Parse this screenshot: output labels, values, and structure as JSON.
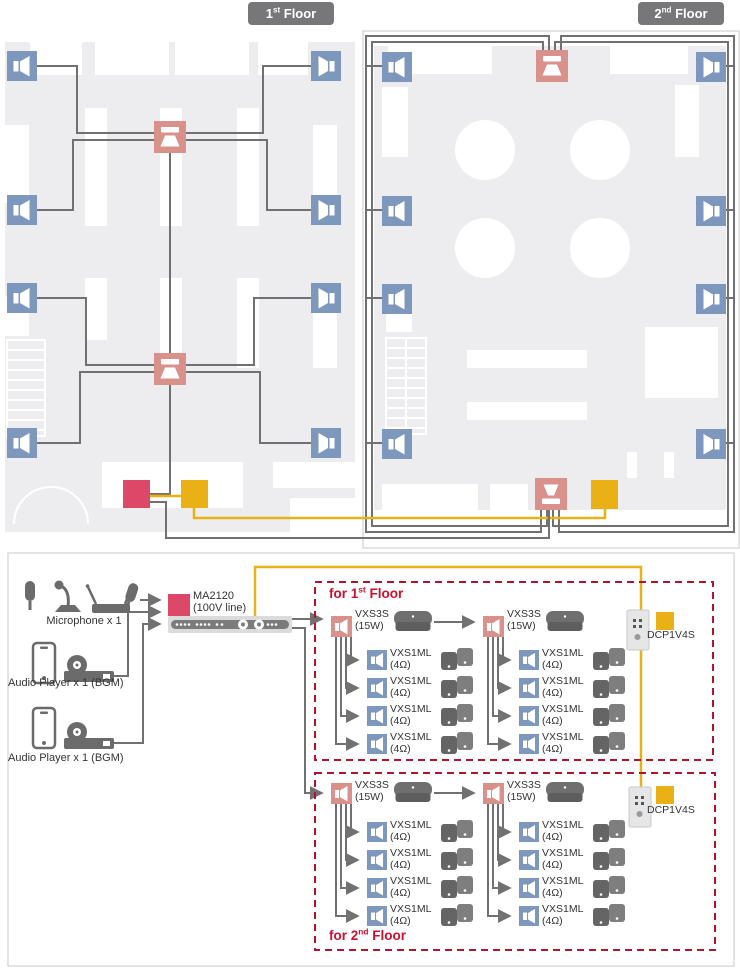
{
  "colors": {
    "accent_red": "#dd4868",
    "accent_yellow": "#eab117",
    "speaker_blue": "#7e97bd",
    "speaker_pink": "#d9918c",
    "wire_gray": "#717171",
    "zone_border_red": "#b5122f",
    "zone_title_red": "#ce0e2d",
    "chip_gray": "#77777a"
  },
  "floor_plans": {
    "floor1_chip": {
      "num": "1",
      "ord": "st",
      "word": " Floor"
    },
    "floor2_chip": {
      "num": "2",
      "ord": "nd",
      "word": " Floor"
    }
  },
  "schematic": {
    "sources": {
      "microphone_label": "Microphone x 1",
      "audio_player1_label": "Audio Player x 1 (BGM)",
      "audio_player2_label": "Audio Player x 1 (BGM)"
    },
    "amplifier": {
      "model": "MA2120",
      "note": "(100V line)"
    },
    "zone1": {
      "title": {
        "prefix": "for ",
        "num": "1",
        "ord": "st",
        "word": " Floor"
      },
      "col1_speaker": {
        "model": "VXS3S",
        "power": "(15W)"
      },
      "col2_speaker": {
        "model": "VXS3S",
        "power": "(15W)"
      },
      "rows_left": [
        {
          "model": "VXS1ML",
          "imp": "(4Ω)"
        },
        {
          "model": "VXS1ML",
          "imp": "(4Ω)"
        },
        {
          "model": "VXS1ML",
          "imp": "(4Ω)"
        },
        {
          "model": "VXS1ML",
          "imp": "(4Ω)"
        }
      ],
      "rows_right": [
        {
          "model": "VXS1ML",
          "imp": "(4Ω)"
        },
        {
          "model": "VXS1ML",
          "imp": "(4Ω)"
        },
        {
          "model": "VXS1ML",
          "imp": "(4Ω)"
        },
        {
          "model": "VXS1ML",
          "imp": "(4Ω)"
        }
      ],
      "control_panel": {
        "model": "DCP1V4S"
      }
    },
    "zone2": {
      "title": {
        "prefix": "for ",
        "num": "2",
        "ord": "nd",
        "word": " Floor"
      },
      "col1_speaker": {
        "model": "VXS3S",
        "power": "(15W)"
      },
      "col2_speaker": {
        "model": "VXS3S",
        "power": "(15W)"
      },
      "rows_left": [
        {
          "model": "VXS1ML",
          "imp": "(4Ω)"
        },
        {
          "model": "VXS1ML",
          "imp": "(4Ω)"
        },
        {
          "model": "VXS1ML",
          "imp": "(4Ω)"
        },
        {
          "model": "VXS1ML",
          "imp": "(4Ω)"
        }
      ],
      "rows_right": [
        {
          "model": "VXS1ML",
          "imp": "(4Ω)"
        },
        {
          "model": "VXS1ML",
          "imp": "(4Ω)"
        },
        {
          "model": "VXS1ML",
          "imp": "(4Ω)"
        },
        {
          "model": "VXS1ML",
          "imp": "(4Ω)"
        }
      ],
      "control_panel": {
        "model": "DCP1V4S"
      }
    }
  }
}
